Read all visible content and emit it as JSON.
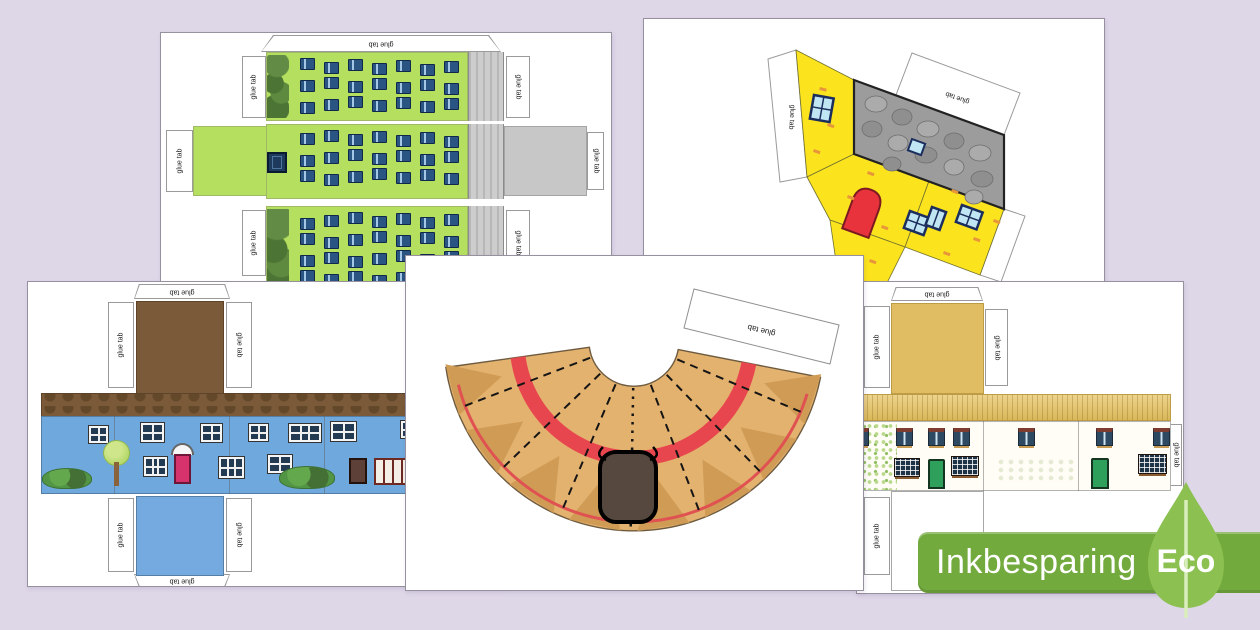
{
  "badge": {
    "label": "Inkbesparing",
    "eco_label": "Eco"
  },
  "glue_tab_label": "glue tab",
  "colors": {
    "background": "#ded7e8",
    "badge_bar": "#73aa3e",
    "badge_leaf": "#8cc152",
    "tower_green": "#b5df5f",
    "tower_side_grey": "#c7c7c7",
    "tower_window_blue": "#2a5583",
    "cottage_yellow": "#fbe31d",
    "cottage_roof_grey": "#9c9c9c",
    "cottage_door_red": "#e8323c",
    "house_wall_blue": "#6fa8dc",
    "house_roof_brown": "#7a5a38",
    "house_door_pink": "#d6336c",
    "row_roof_gold": "#e6c25f",
    "row_door_green": "#2ea05c",
    "roundhouse_tan": "#e4b26f",
    "roundhouse_band_red": "#e8464e",
    "roundhouse_door_grey": "#56483e"
  }
}
